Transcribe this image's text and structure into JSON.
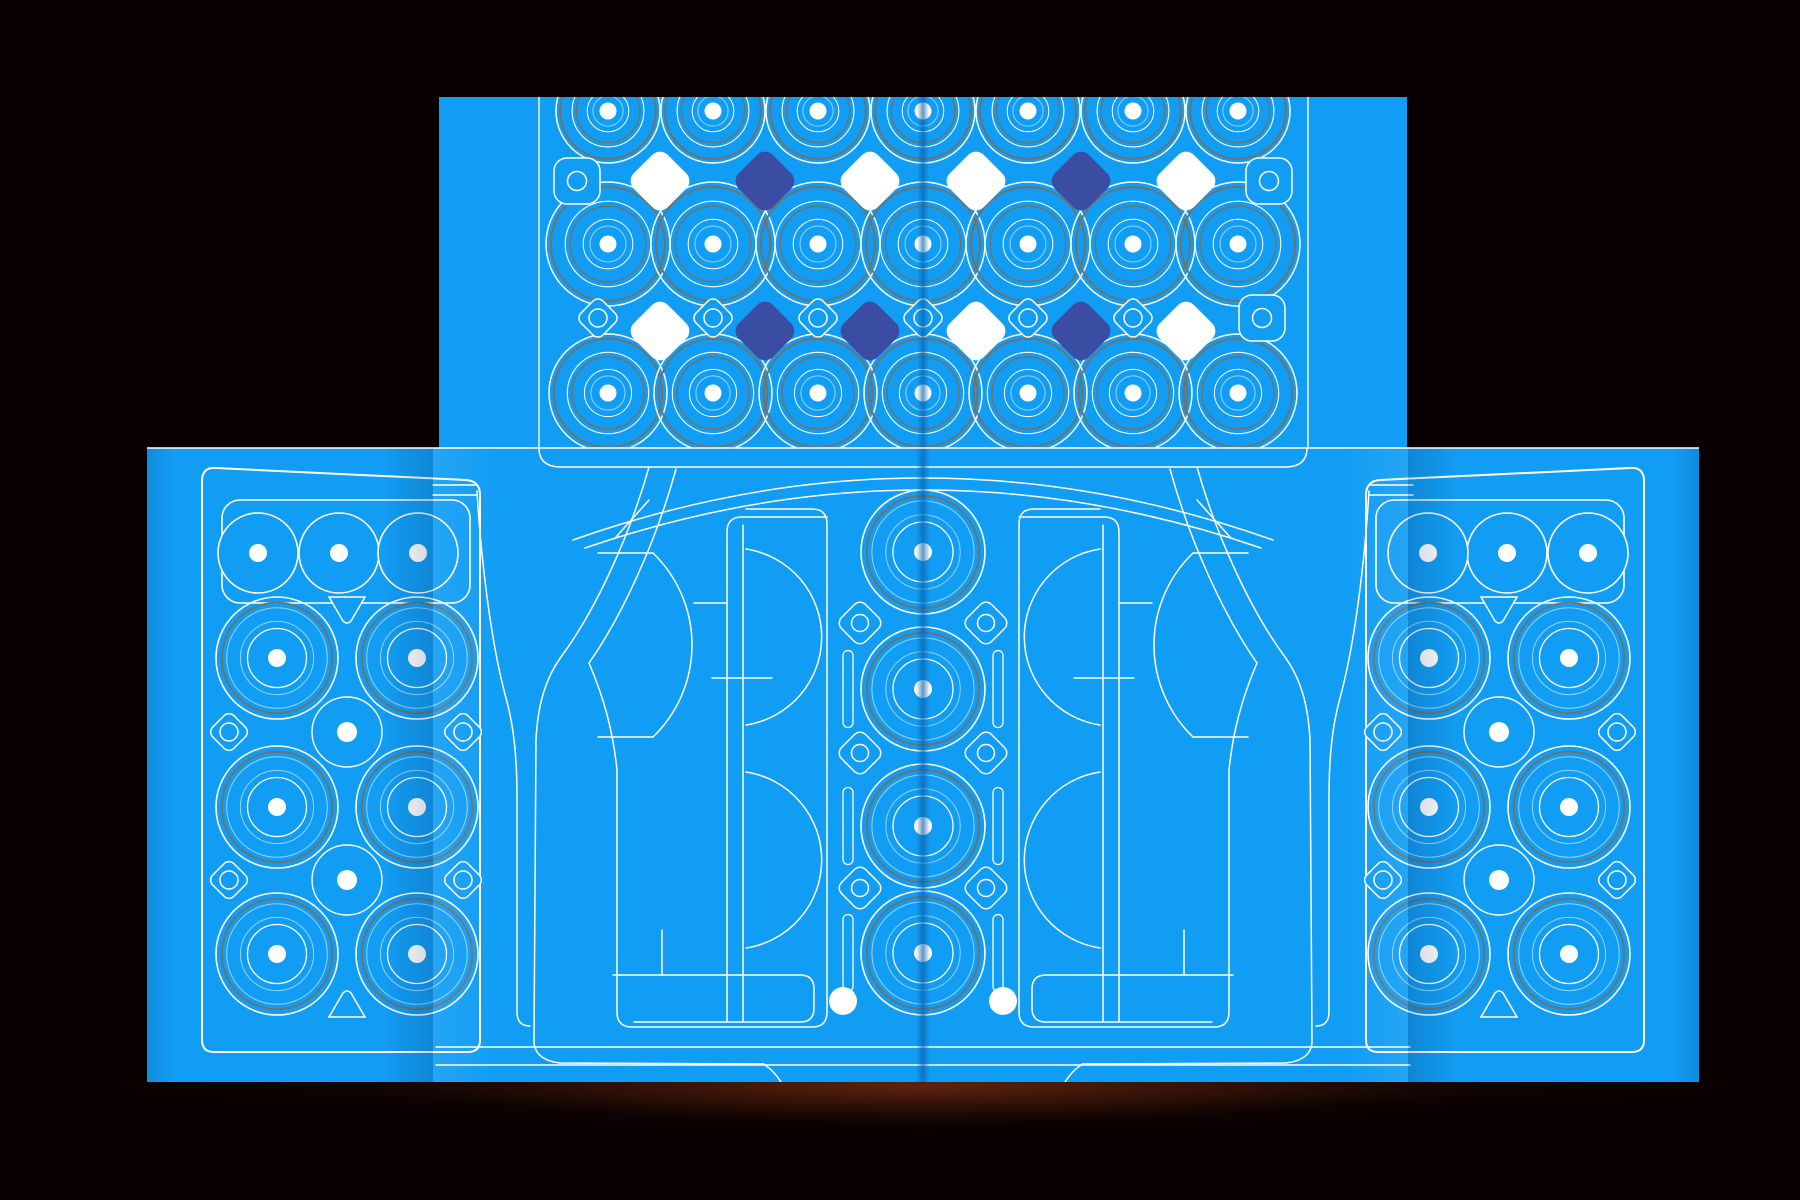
{
  "canvas": {
    "width": 1800,
    "height": 1200,
    "background": "#090101"
  },
  "colors": {
    "panel_blue": "#129DF4",
    "line_white": "#FFFFFF",
    "line_faint": "rgba(255,255,255,0.55)",
    "ring_gray": "#6F736C",
    "diamond_navy": "#3A4DA2",
    "diamond_white": "#FFFFFF",
    "fold_dark": "#0A5FA6",
    "shadow_core": "rgba(96,36,14,0.95)",
    "shadow_mid": "rgba(58,20,8,0.55)",
    "shadow_edge": "rgba(10,2,0,0)"
  },
  "top_panel": {
    "x": 439,
    "y": 97,
    "w": 968,
    "h": 351,
    "fold_lines_white_x": [
      539,
      1308
    ],
    "center_fold_x": 923,
    "circle_columns_x": [
      608,
      713,
      818,
      923,
      1028,
      1133,
      1238
    ],
    "circle_rows": [
      {
        "y": 111,
        "r": 52
      },
      {
        "y": 244,
        "r": 62
      },
      {
        "y": 393,
        "r": 59
      }
    ],
    "ring_stack": [
      [
        1.0,
        "w",
        1.5
      ],
      [
        0.92,
        "g",
        2.0
      ],
      [
        0.69,
        "w",
        1.1
      ],
      [
        0.61,
        "g",
        1.5
      ],
      [
        0.4,
        "w",
        1.0
      ],
      [
        0.29,
        "f",
        1.0
      ]
    ],
    "dot_r": 8.5,
    "diamond_row_a": {
      "y": 181,
      "xs": [
        660,
        765,
        870,
        976,
        1081,
        1186
      ],
      "colors": [
        "white",
        "navy",
        "white",
        "white",
        "navy",
        "white"
      ]
    },
    "diamond_row_b": {
      "y": 331,
      "xs": [
        660,
        765,
        870,
        976,
        1081,
        1186
      ],
      "colors": [
        "white",
        "navy",
        "navy",
        "white",
        "navy",
        "white"
      ]
    },
    "small_diamonds_b": {
      "y": 318,
      "xs": [
        598,
        713,
        818,
        923,
        1028,
        1133
      ],
      "side": 31,
      "rx": 7,
      "circle_r": 9
    },
    "corner_squares": [
      {
        "x": 577,
        "y": 181
      },
      {
        "x": 1269,
        "y": 181
      },
      {
        "x": 1262,
        "y": 318
      }
    ],
    "square_size": 46,
    "square_rx": 13,
    "square_circle_r": 9.5,
    "big_diamond_side": 48,
    "big_diamond_rx": 11
  },
  "band": {
    "x": 147,
    "y": 448,
    "w": 1552,
    "h": 634,
    "folds_x": [
      433,
      1408
    ],
    "center_fold_x": 923,
    "mirror_axis": 923,
    "top_line_y": 448
  },
  "side_panel": {
    "border_path": "M 202,1040 Q 202,1052 214,1052 L 468,1052 Q 480,1052 480,1040 L 480,495 Q 480,481 466,480 L 216,468 Q 202,467 202,481 Z",
    "grille": {
      "x": 222,
      "y": 500,
      "w": 248,
      "h": 103,
      "rx": 18
    },
    "top_circles": {
      "y": 553,
      "xs": [
        258,
        339,
        418
      ],
      "r": 40
    },
    "big_circles": {
      "xs": [
        277,
        417
      ],
      "ys": [
        658,
        807,
        954
      ],
      "r": 61
    },
    "mid_circles": {
      "x": 347,
      "ys": [
        732,
        880
      ],
      "r": 35,
      "dot_r": 10
    },
    "edge_diamonds": {
      "xs": [
        229,
        463
      ],
      "ys": [
        732,
        880
      ],
      "side": 30,
      "rx": 7,
      "circle_r": 9
    },
    "triangles": [
      {
        "x": 347,
        "y": 609,
        "dir": "down"
      },
      {
        "x": 347,
        "y": 1005,
        "dir": "up"
      }
    ]
  },
  "panel_ring_stack": [
    [
      1.0,
      "w",
      1.6
    ],
    [
      0.905,
      "g",
      2.0
    ],
    [
      0.825,
      "f",
      1.0
    ],
    [
      0.6,
      "f",
      1.0
    ],
    [
      0.484,
      "w",
      1.3
    ]
  ],
  "cab": {
    "center_paths": [
      "M 539,448 Q 539,467 561,467 L 1285,467 Q 1307,467 1307,448",
      "M 573,540 Q 923,416 1273,540",
      "M 585,548 Q 923,432 1261,548",
      "M 436,1047 L 1410,1047",
      "M 436,1065 L 1410,1065"
    ],
    "left_paths": [
      "M 477,491 C 481,560 491,643 506,698 C 514,727 517,758 517,798 L 517,1012 Q 517,1026 530,1026",
      "M 649,467 C 629,538 595,611 561,657 C 545,679 538,705 536,739 L 534,1042 Q 535,1060 560,1063 L 764,1064",
      "M 676,469 C 656,542 622,616 589,663 C 604,698 613,731 617,770 L 617,1012 Q 617,1027 632,1027 L 812,1027 Q 827,1027 827,1012 L 827,524 Q 827,509 812,509 L 746,509",
      "M 727,1022 L 727,532 Q 727,517 742,517 L 827,517",
      "M 743,1022 L 743,525",
      "M 653,553 A 128 128 0 0 1 653,737",
      "M 598,553 L 653,553",
      "M 598,737 L 653,737",
      "M 746,549 A 89 89 0 0 1 746,725",
      "M 746,772 A 89 89 0 0 1 746,948",
      "M 649,500 L 616,537",
      "M 433,485 L 477,485",
      "M 433,495 L 477,495",
      "M 694,603 L 727,603",
      "M 712,678 L 772,678",
      "M 662,930 L 662,975",
      "M 613,975 L 800,975 Q 814,975 814,989 L 814,1008 Q 814,1022 800,1022 L 634,1022",
      "M 765,1065 Q 774,1071 781,1082"
    ],
    "engine": {
      "x": 923,
      "cluster_ys": [
        552,
        689,
        826,
        953
      ],
      "r": 62,
      "dot_r": 9,
      "diamonds": {
        "x": 860,
        "ys": [
          623,
          753,
          888
        ],
        "side": 34,
        "rx": 8,
        "circle_r": 8.5
      },
      "slots": {
        "x": 848,
        "ys": [
          689,
          826,
          953
        ],
        "w": 10,
        "h": 77,
        "rx": 5
      }
    },
    "bed_dot": {
      "x": 843,
      "y": 1001,
      "r": 14
    }
  },
  "shadow": {
    "cx": 923,
    "cy": 1086,
    "rx": 600,
    "ry": 46,
    "rx2": 860,
    "ry2": 26
  }
}
